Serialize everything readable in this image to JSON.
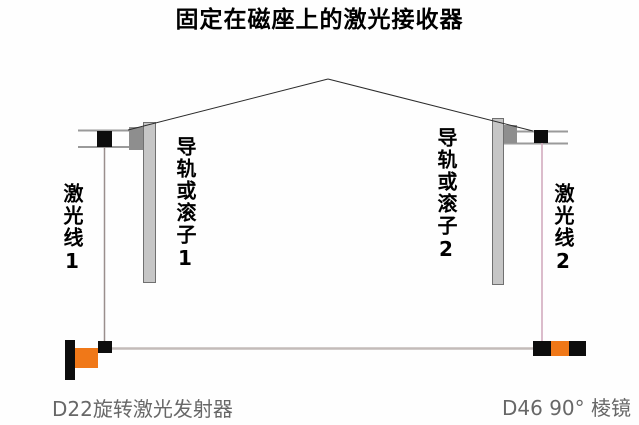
{
  "diagram": {
    "title": "固定在磁座上的激光接收器",
    "left": {
      "laser_label": "激光线1",
      "rail_label": "导轨或滚子1"
    },
    "right": {
      "rail_label": "导轨或滚子2",
      "laser_label": "激光线2"
    },
    "bottom": {
      "transmitter_label": "D22旋转激光发射器",
      "prism_label": "D46 90° 棱镜"
    },
    "colors": {
      "orange": "#f07818",
      "black_component": "#0d0d0d",
      "rail_fill": "#c6c6c6",
      "rail_border": "#707070",
      "slider_gray": "#8e8e8e",
      "bracket_line": "#9a9a9a",
      "laser_line_1": "#9a8f8d",
      "laser_line_2": "#cfa6ba",
      "laser_line_horizontal": "#c3bbb9",
      "pointer_line": "#2b2b2b",
      "caption_text": "#676767"
    }
  }
}
